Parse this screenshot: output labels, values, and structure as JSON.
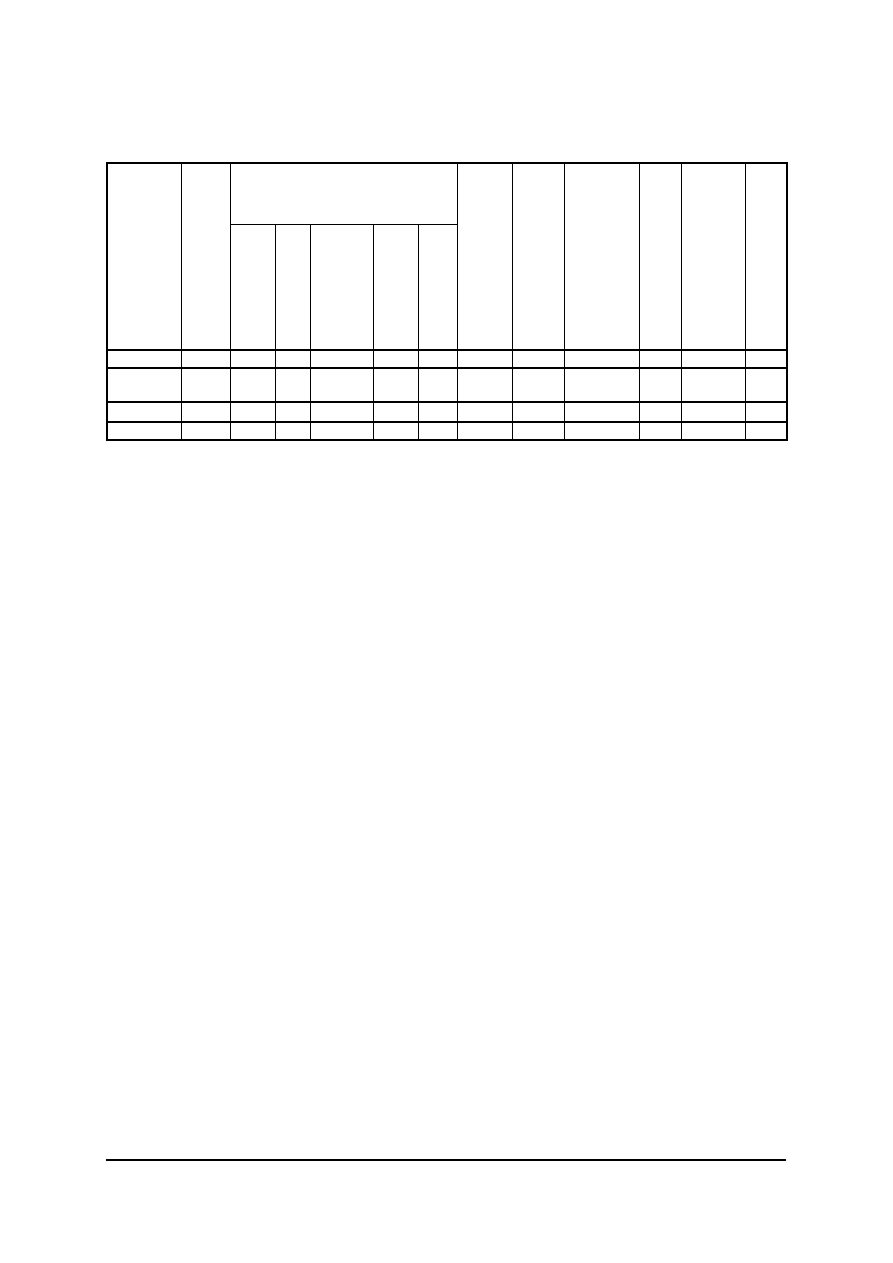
{
  "page": {
    "width_px": 893,
    "height_px": 1263,
    "background_color": "#ffffff"
  },
  "table": {
    "left_px": 106,
    "top_px": 162,
    "border_color": "#000000",
    "column_count": 13,
    "column_widths_px": [
      74,
      49,
      45,
      35,
      63,
      45,
      39,
      55,
      52,
      75,
      42,
      64,
      42
    ],
    "header": {
      "top_row_height_px": 61,
      "sub_row_height_px": 126,
      "merged_span": {
        "start_column": 3,
        "column_count": 5
      },
      "cell_text": ""
    },
    "body_row_heights_px": [
      18,
      34,
      20,
      18
    ],
    "cell_text": ""
  },
  "footer_rule": {
    "left_px": 106,
    "top_px": 1159,
    "width_px": 680,
    "height_px": 2,
    "color": "#000000"
  }
}
